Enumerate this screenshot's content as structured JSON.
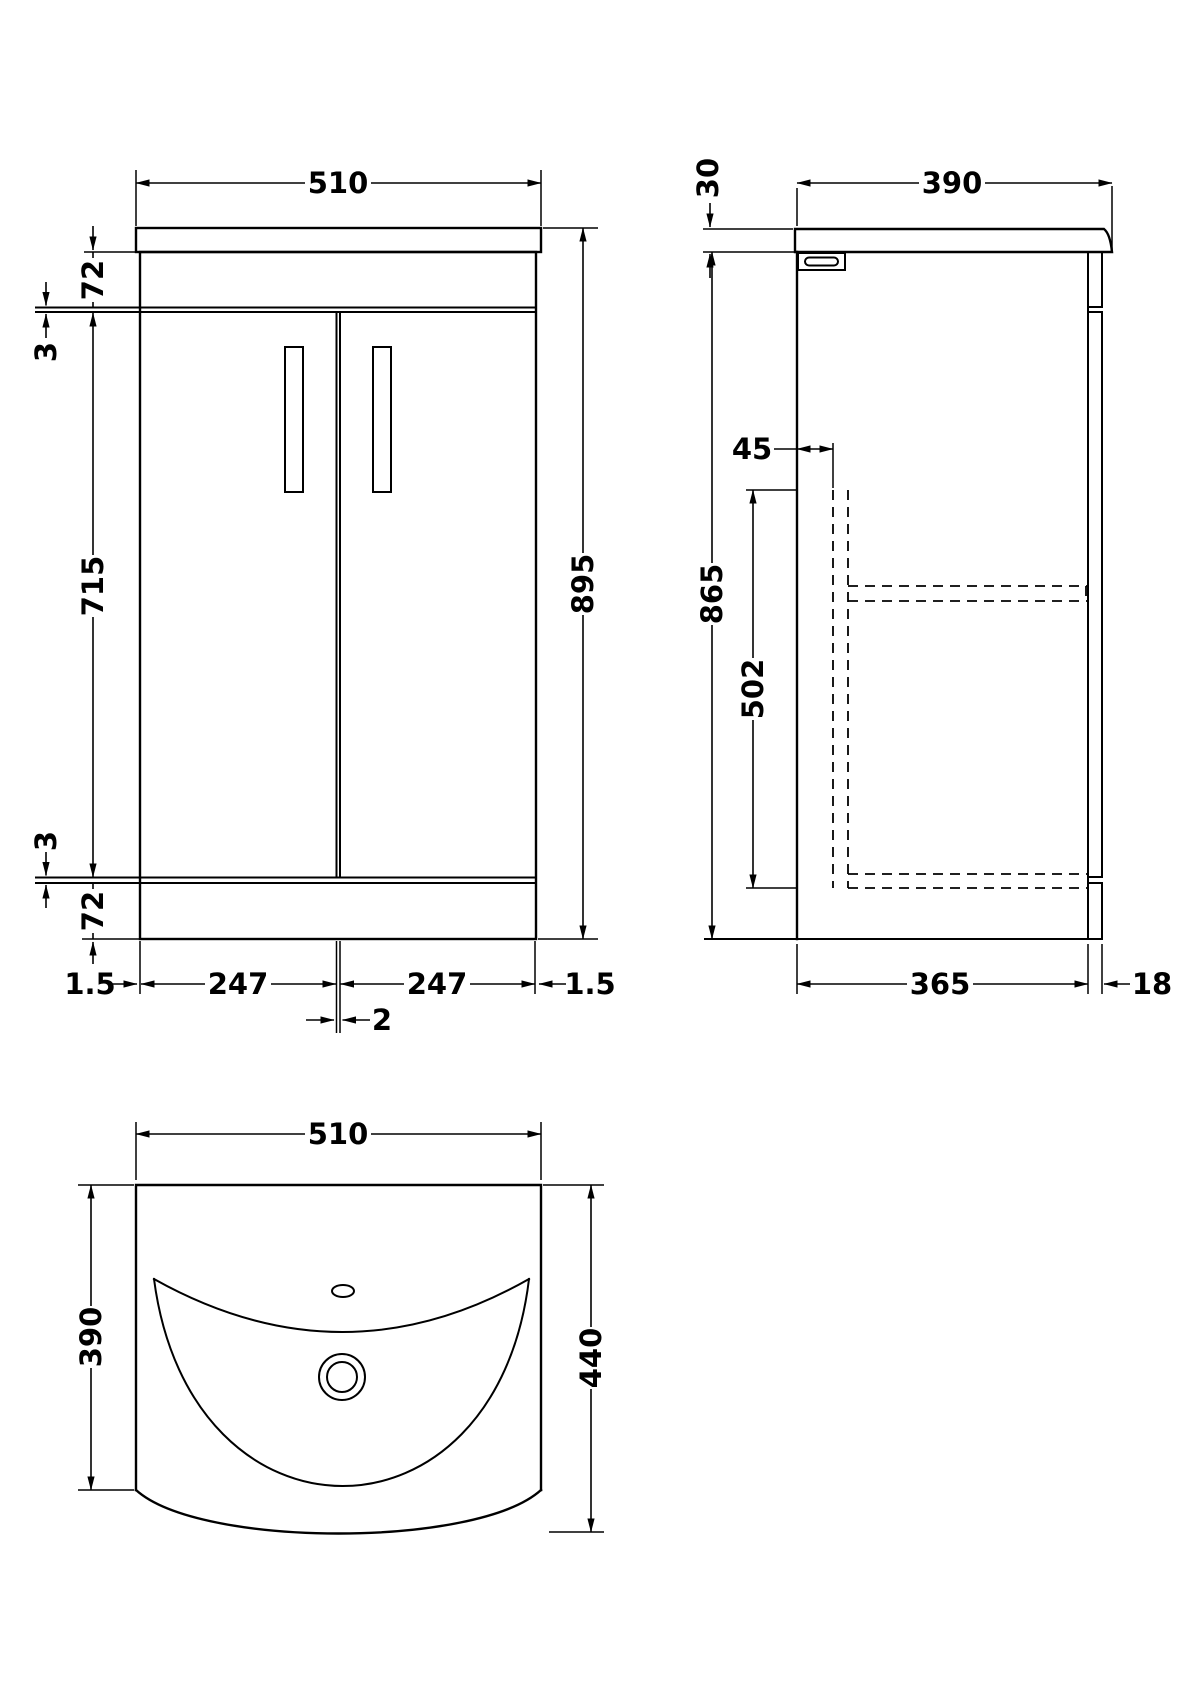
{
  "front_view": {
    "width": "510",
    "top_rail_height": "72",
    "top_gap": "3",
    "door_height": "715",
    "bottom_gap": "3",
    "plinth_height": "72",
    "overall_height": "895",
    "left_edge": "1.5",
    "left_door_width": "247",
    "right_door_width": "247",
    "right_edge": "1.5",
    "door_gap": "2"
  },
  "side_view": {
    "worktop_thickness": "30",
    "worktop_depth": "390",
    "back_inset": "45",
    "cabinet_height": "865",
    "internal_height": "502",
    "body_depth": "365",
    "door_thickness": "18"
  },
  "plan_view": {
    "width": "510",
    "basin_depth": "390",
    "overall_depth": "440"
  }
}
